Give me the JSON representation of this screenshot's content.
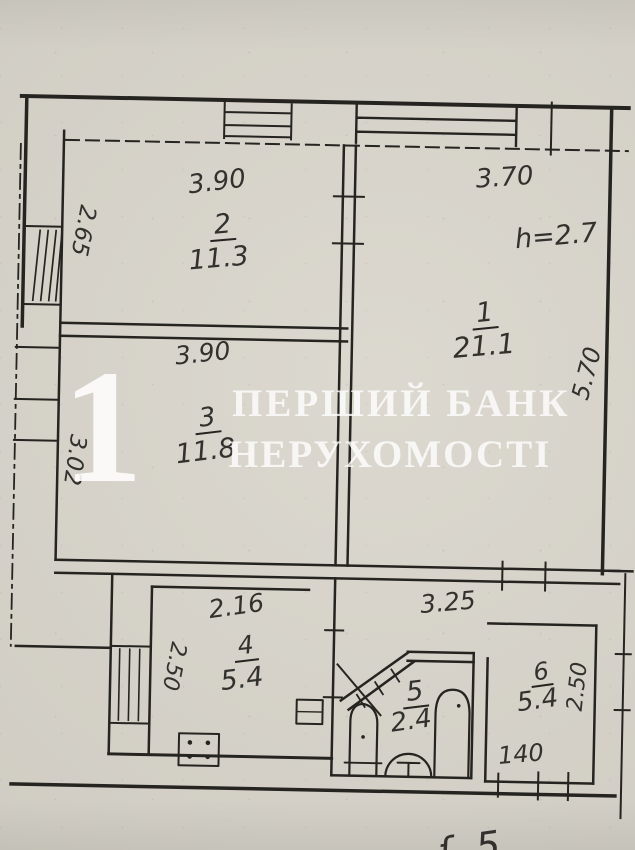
{
  "watermark": {
    "numeral": "1",
    "line1": "ПЕРШИЙ БАНК",
    "line2": "НЕРУХОМОСТІ"
  },
  "rooms": {
    "room1": {
      "number": "1",
      "area": "21.1",
      "height_note": "h=2.7",
      "dim_top": "3.70",
      "dim_right": "5.70"
    },
    "room2": {
      "number": "2",
      "area": "11.3",
      "dim_top": "3.90",
      "dim_left": "2.65"
    },
    "room3": {
      "number": "3",
      "area": "11.8",
      "dim_top": "3.90",
      "dim_left": "3.02"
    },
    "room4": {
      "number": "4",
      "area": "5.4",
      "dim_top": "2.16",
      "dim_left": "2.50"
    },
    "room5": {
      "number": "5",
      "area": "2.4"
    },
    "room6": {
      "number": "6",
      "area": "5.4",
      "dim_right": "2.50",
      "dim_bottom": "140"
    },
    "corridor": {
      "dim": "3.25"
    }
  },
  "notes": {
    "bottom_right_fragment": "ʄ. 5"
  },
  "colors": {
    "paper": "#d8d4ca",
    "ink": "#262420",
    "watermark": "#ffffff"
  }
}
